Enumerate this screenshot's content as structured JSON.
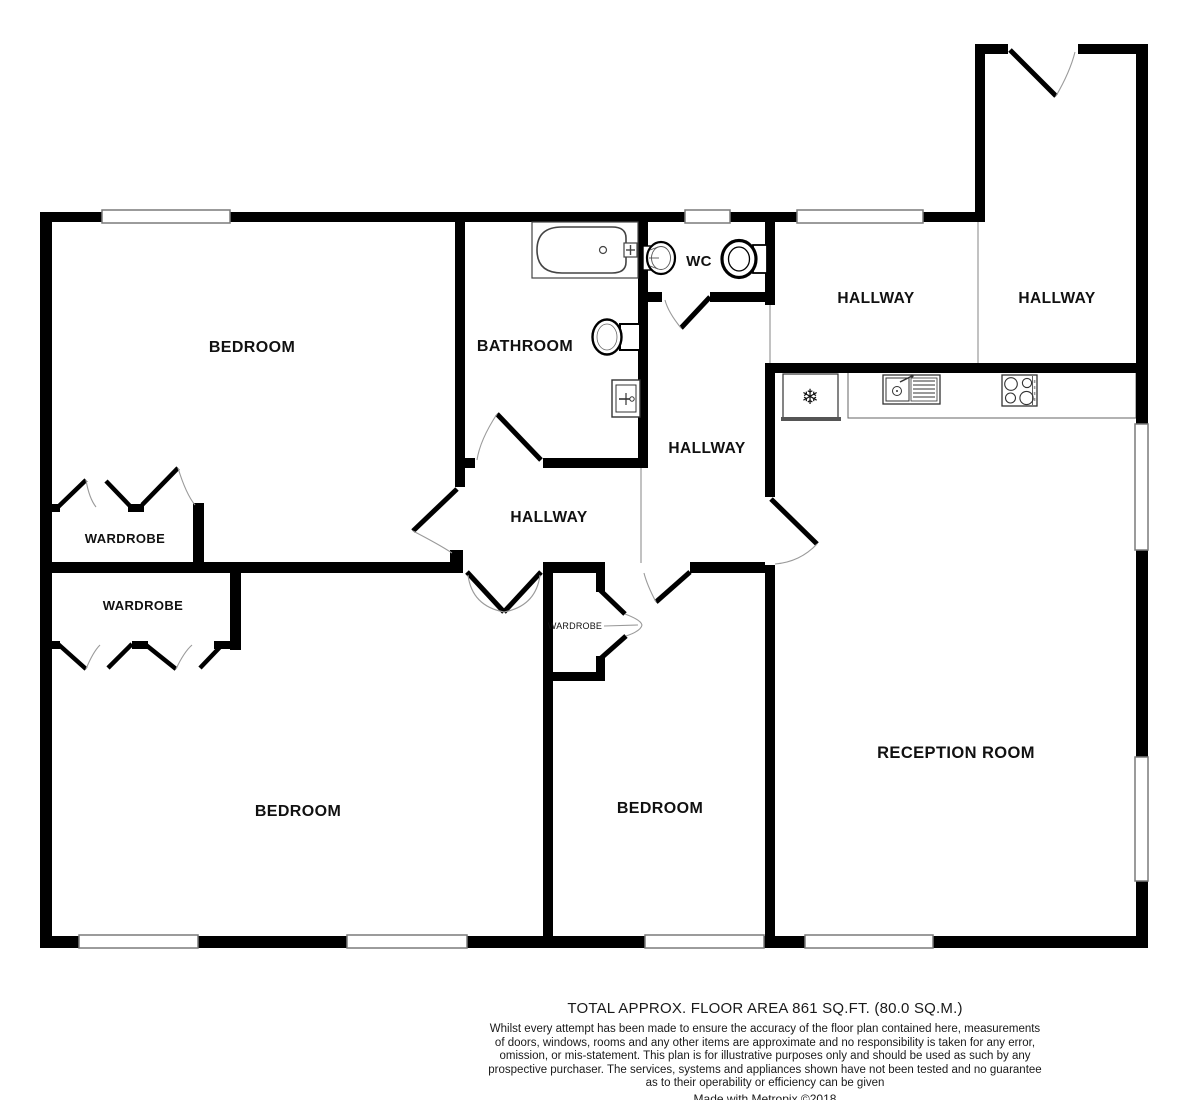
{
  "plan": {
    "rooms": [
      {
        "id": "bedroom-1",
        "label": "BEDROOM"
      },
      {
        "id": "bathroom",
        "label": "BATHROOM"
      },
      {
        "id": "wc",
        "label": "WC"
      },
      {
        "id": "hallway-top-left",
        "label": "HALLWAY"
      },
      {
        "id": "hallway-top-right",
        "label": "HALLWAY"
      },
      {
        "id": "hallway-center",
        "label": "HALLWAY"
      },
      {
        "id": "hallway-inner",
        "label": "HALLWAY"
      },
      {
        "id": "wardrobe-upper",
        "label": "WARDROBE"
      },
      {
        "id": "wardrobe-lower",
        "label": "WARDROBE"
      },
      {
        "id": "wardrobe-small",
        "label": "WARDROBE"
      },
      {
        "id": "bedroom-2",
        "label": "BEDROOM"
      },
      {
        "id": "bedroom-3",
        "label": "BEDROOM"
      },
      {
        "id": "reception-room",
        "label": "RECEPTION ROOM"
      }
    ],
    "fixtures": {
      "fridge_glyph": "❄"
    }
  },
  "footer": {
    "area_line": "TOTAL APPROX. FLOOR AREA 861 SQ.FT. (80.0 SQ.M.)",
    "disclaimer_lines": [
      "Whilst every attempt has been made to ensure the accuracy of the floor plan contained here, measurements",
      "of doors, windows, rooms and any other items are approximate and no responsibility is taken for any error,",
      "omission, or mis-statement. This plan is for illustrative purposes only and should be used as such by any",
      "prospective purchaser. The services, systems and appliances shown have not been tested and no guarantee",
      "as to their operability or efficiency can be given"
    ],
    "credit": "Made with Metropix ©2018"
  },
  "colors": {
    "wall": "#000000",
    "window_frame": "#7a7a7a",
    "divider": "#9a9a9a",
    "background": "#ffffff"
  }
}
